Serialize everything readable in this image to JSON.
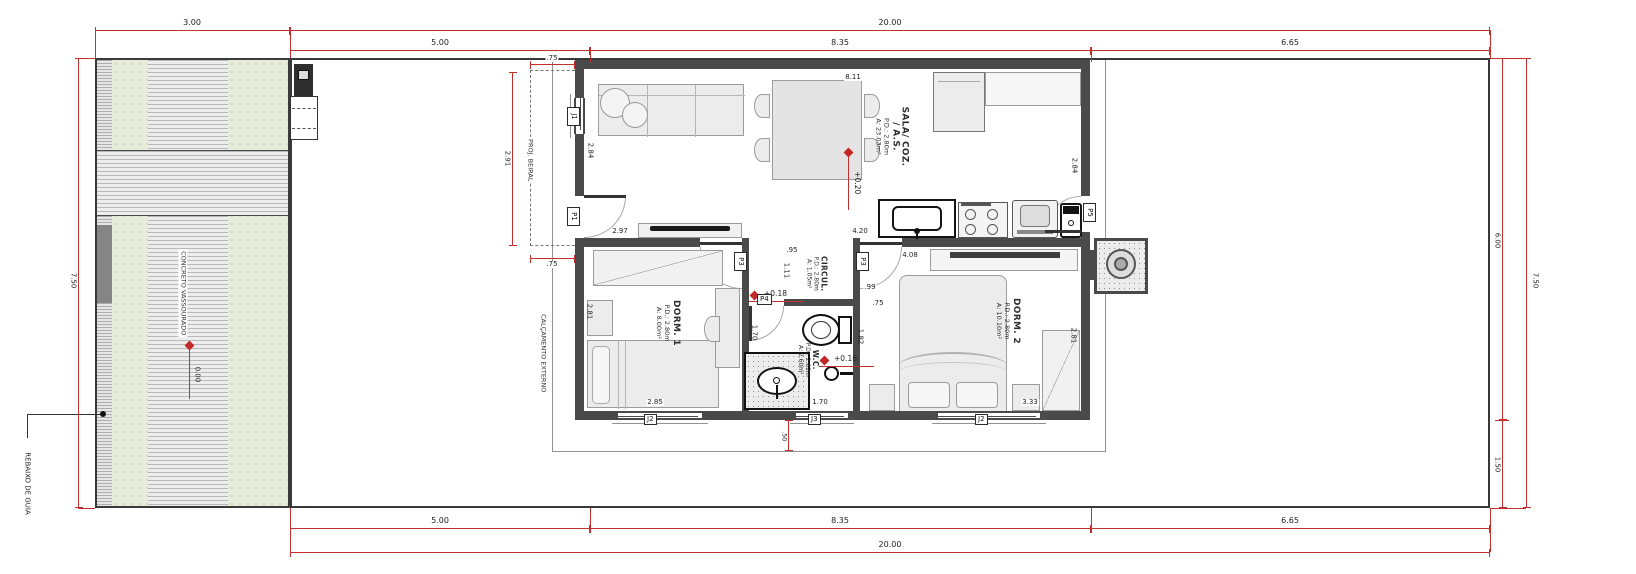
{
  "site": {
    "driveway_surface_label": "CONCRETO VASSOURADO",
    "curb_note": "REBAIXO DE GUIA",
    "walkway_label": "CALÇAMENTO EXTERNO",
    "eave_label": "PROJ. BEIRAL"
  },
  "dims": {
    "top": {
      "lot_drive": "3.00",
      "lot": "20.00",
      "seg1": "5.00",
      "seg2": "8.35",
      "seg3": "6.65",
      "eave": ".75"
    },
    "bottom": {
      "seg1": "5.00",
      "seg2": "8.35",
      "seg3": "6.65",
      "lot": "20.00"
    },
    "left": {
      "lot": "7.50"
    },
    "right": {
      "house": "6.00",
      "back": "1.50",
      "lot": "7.50"
    },
    "interior": {
      "eave_len": "2.91",
      "eave_w2": ".75",
      "sala_left": "2.84",
      "sala_top": "8.11",
      "sala_right": "2.84",
      "tv_wall": "2.97",
      "sink_counter": "4.20",
      "circ_w": ".95",
      "shelf": "4.08",
      "circ_h": "1.11",
      "circ_r": ".99",
      "wall_stub": ".75",
      "dorm1_h": "2.81",
      "dorm1_w": "2.85",
      "wc_h": "1.70",
      "wc_w": "1.70",
      "wc_r": "1.82",
      "dorm2_w": "3.33",
      "dorm2_h": "2.81",
      "walk_offset": ".50"
    }
  },
  "levels": {
    "sala": "+0.20",
    "wc_upper": "+0.18",
    "wc_lower": "+0.16",
    "driveway": "0.00"
  },
  "rooms": {
    "sala": {
      "name": "SALA/ COZ.",
      "name2": "/ A.S.",
      "pd": "P.D.: 2.80m",
      "area": "A: 23.03m²"
    },
    "dorm1": {
      "name": "DORM. 1",
      "pd": "P.D.: 2.80m",
      "area": "A: 8.00m²"
    },
    "circ": {
      "name": "CIRCUL.",
      "pd": "P.D.: 2.80m",
      "area": "A: 1.05m²"
    },
    "wc": {
      "name": "W.C.",
      "pd": "P.D.: 2.82m",
      "area": "A: 2.60m²"
    },
    "dorm2": {
      "name": "DORM. 2",
      "pd": "P.D.: 2.80m",
      "area": "A: 10.10m²"
    }
  },
  "openings": {
    "j1": "J1",
    "p1": "P1",
    "p3_dorm1": "P3",
    "p3_dorm2": "P3",
    "p4": "P4",
    "p5": "P5",
    "j2_dorm1": "J2",
    "j3": "J3",
    "j2_dorm2": "J2"
  }
}
